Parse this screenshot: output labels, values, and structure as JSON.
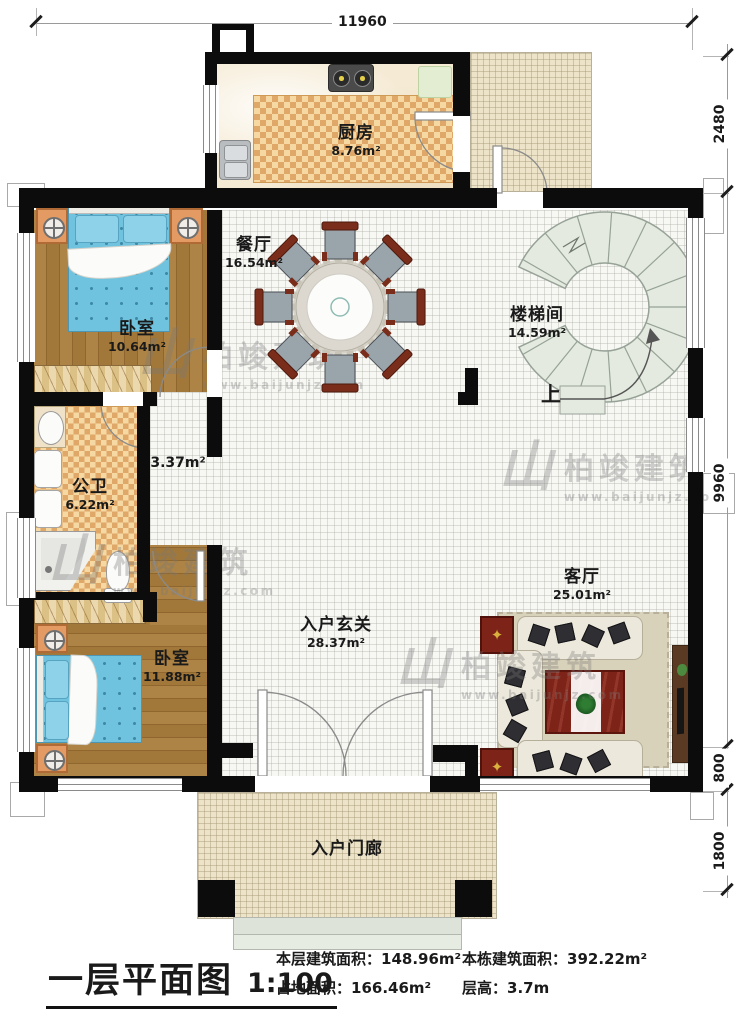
{
  "rooms": {
    "kitchen": {
      "label": "厨房",
      "area": "8.76m²"
    },
    "dining": {
      "label": "餐厅",
      "area": "16.54m²"
    },
    "bedroom_top": {
      "label": "卧室",
      "area": "10.64m²"
    },
    "stairwell": {
      "label": "楼梯间",
      "area": "14.59m²"
    },
    "bathroom": {
      "label": "公卫",
      "area": "6.22m²"
    },
    "corridor": {
      "area": "3.37m²"
    },
    "foyer": {
      "label": "入户玄关",
      "area": "28.37m²"
    },
    "living": {
      "label": "客厅",
      "area": "25.01m²"
    },
    "bedroom_bottom": {
      "label": "卧室",
      "area": "11.88m²"
    },
    "porch": {
      "label": "入户门廊"
    }
  },
  "stairs": {
    "up_label": "上"
  },
  "dimensions": {
    "top": "11960",
    "right_top": "2480",
    "right_middle": "9960",
    "right_lower": "800",
    "right_bottom": "1800"
  },
  "watermark": {
    "logo_glyph": "山",
    "brand": "柏竣建筑",
    "url": "www.baijunjz.com"
  },
  "caption": {
    "title": "一层平面图",
    "scale": "1:100",
    "stats": [
      {
        "label": "本层建筑面积：",
        "value": "148.96m²"
      },
      {
        "label": "本栋建筑面积：",
        "value": "392.22m²"
      },
      {
        "label": "占地面积：",
        "value": "166.46m²"
      },
      {
        "label": "层高：",
        "value": "3.7m"
      }
    ]
  },
  "colors": {
    "wall": "#0c0c0c",
    "wood": "#a9813f",
    "checker_light": "#f6d9a2",
    "checker_dark": "#dfa869",
    "tile": "#f7f7f4",
    "terrace": "#ece3c8",
    "stair": "#e4eadf",
    "bed": "#6fc3de",
    "accent_red": "#7e2318"
  }
}
